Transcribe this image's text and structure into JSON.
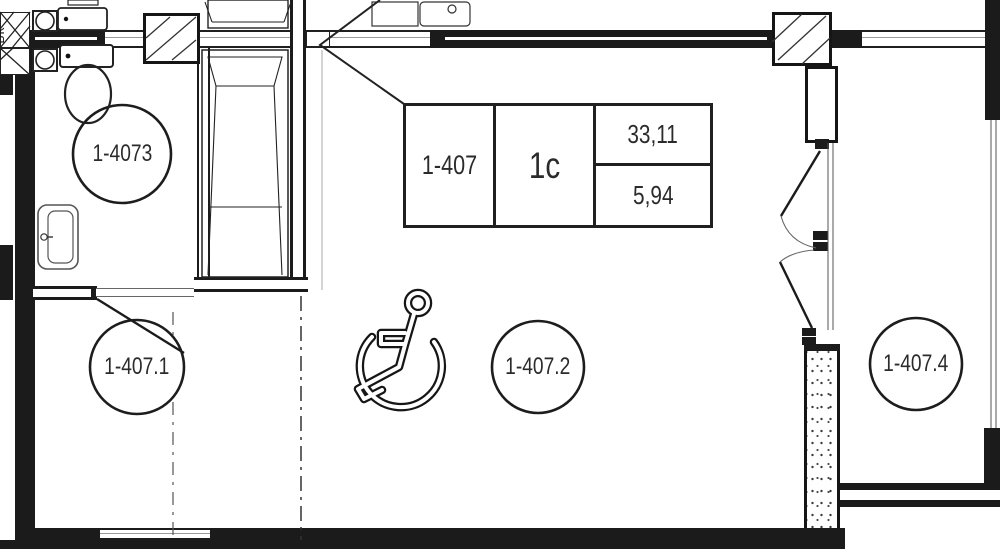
{
  "plan": {
    "stamp": {
      "flat_number": "1-407",
      "layout_type": "1c",
      "total_area": "33,11",
      "living_area": "5,94"
    },
    "tags": {
      "bathroom": "1-4073",
      "hall": "1-407.1",
      "room": "1-407.2",
      "adjacent": "1-407.4"
    },
    "riser_label": "ВК"
  }
}
